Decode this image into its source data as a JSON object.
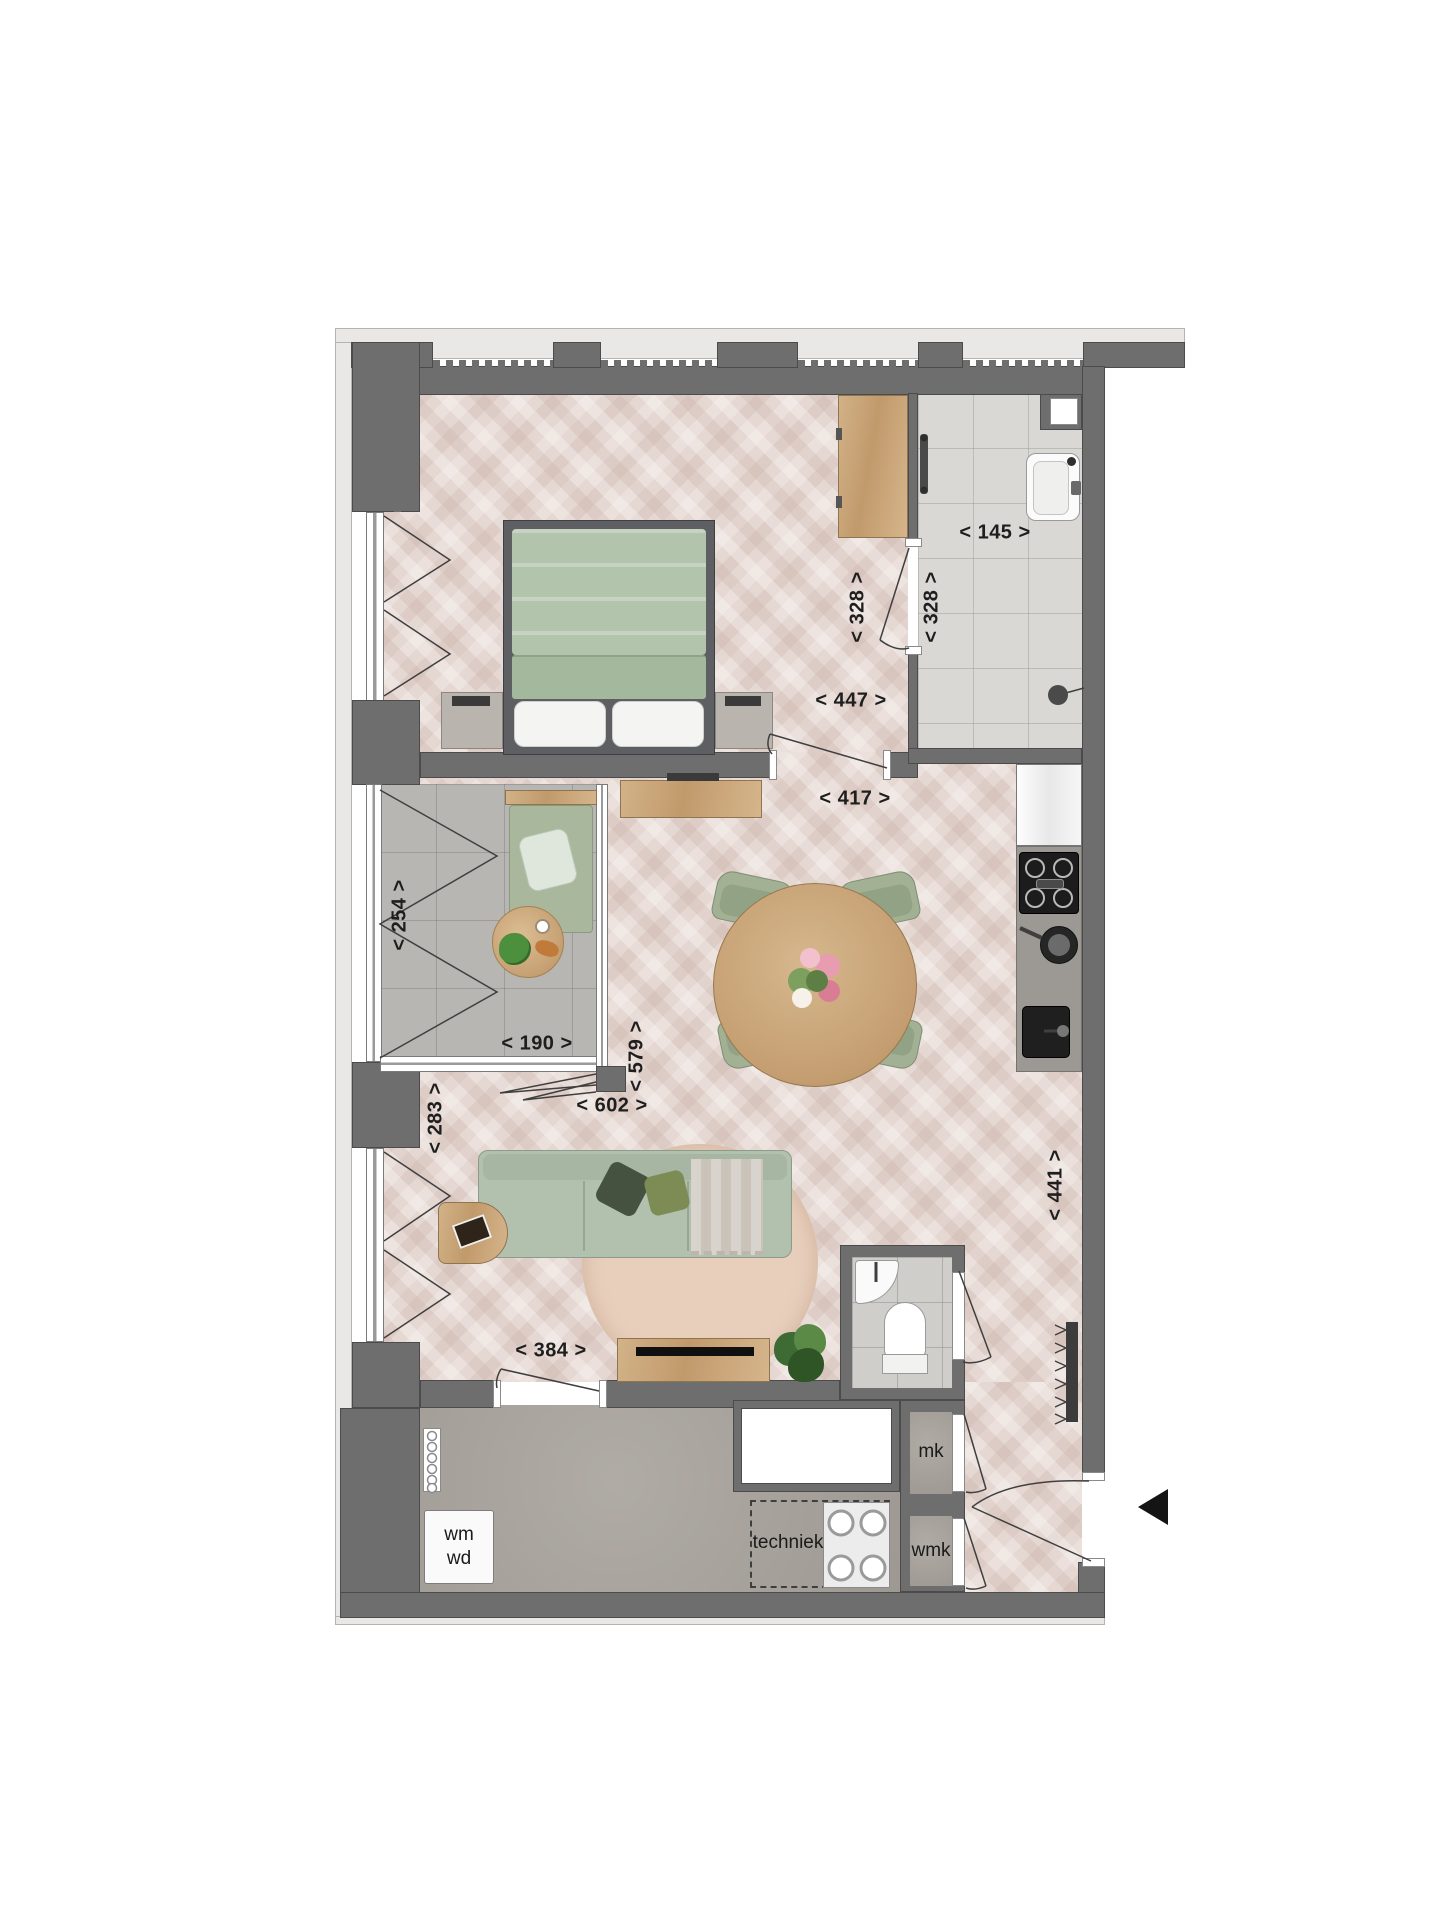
{
  "plan_type": "apartment-floor-plan",
  "dimensions": {
    "d447": "< 447 >",
    "d417": "< 417 >",
    "d328_bedroom": "< 328 >",
    "d328_bathroom": "< 328 >",
    "d145": "< 145 >",
    "d254": "< 254 >",
    "d190": "< 190 >",
    "d579": "< 579 >",
    "d602": "< 602 >",
    "d283": "< 283 >",
    "d441": "< 441 >",
    "d384": "< 384 >"
  },
  "room_labels": {
    "wm": "wm",
    "wd": "wd",
    "techniek": "techniek",
    "mk": "mk",
    "wmk": "wmk"
  },
  "icons": {
    "entrance_arrow": "black-triangle-pointing-left"
  },
  "colors": {
    "wall": "#6e6e6e",
    "wall_outline": "#4b4b4b",
    "exterior_band": "#e9e8e6",
    "wood_floor": "#e5d7d1",
    "balcony_tile": "#b7b6b2",
    "bathroom_tile": "#d9d8d5",
    "concrete_floor": "#a7a29b",
    "furniture_wood": "#c9a87e",
    "sofa_green": "#b2c1ae",
    "bed_green": "#b3c4ad",
    "entrance_arrow": "#141414"
  }
}
